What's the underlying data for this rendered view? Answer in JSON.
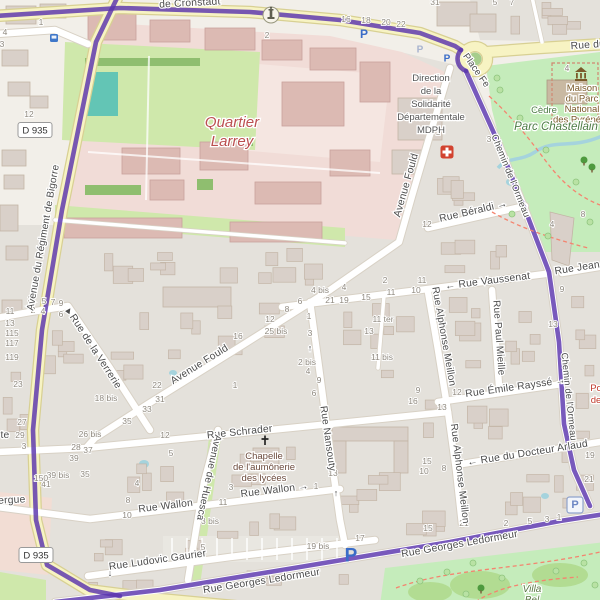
{
  "map": {
    "colors": {
      "base": "#f2efe9",
      "residential": "#e4e1db",
      "building": "#d9d0c9",
      "building_stroke": "#c3b5a6",
      "barracks": "#f1dcd7",
      "barracks_court": "#f5e6e1",
      "barracks_building": "#dcbab3",
      "barracks_building_stroke": "#c9a29b",
      "grass": "#cfe8ab",
      "park": "#c5ecbb",
      "park_blob": "#b2dc92",
      "hedge": "#8fbe6f",
      "pitch": "#63c5b5",
      "road_yellow": "#f7f3c3",
      "road_yellow_casing": "#d8d093",
      "road_white": "#ffffff",
      "road_casing": "#d8d1c5",
      "route_purple": "#5a35ad",
      "water": "#a5d3dd",
      "path_red": "#f4846f",
      "street_text": "#4c4c4c",
      "housenumber_text": "#8f897f",
      "quartier_red": "#bb4f4f",
      "park_text": "#4e7d46",
      "tourism_brown": "#7a5a2a",
      "chapel_text": "#6b4a3c",
      "gray_text": "#555555",
      "poi_red_text": "#c0392b",
      "parking_blue": "#3a6cc8",
      "parking_muted": "#a8b4cf",
      "roundabout_green": "#a6cd8c",
      "medical_red": "#d2422f"
    },
    "street_labels": [
      {
        "text": "de Cronstadt",
        "x": 190,
        "y": 6,
        "rot": -3
      },
      {
        "text": "Place Fe",
        "x": 474,
        "y": 72,
        "rot": 55,
        "s": 9.5
      },
      {
        "text": "Rue du",
        "x": 588,
        "y": 48,
        "rot": -4
      },
      {
        "text": "Avenue du Régiment de Bigorre",
        "x": 46,
        "y": 238,
        "rot": -80,
        "s": 10
      },
      {
        "text": "Avenue Fould",
        "x": 409,
        "y": 186,
        "rot": -74
      },
      {
        "text": "Avenue Fould",
        "x": 201,
        "y": 367,
        "rot": -32
      },
      {
        "text": "Rue Béraldi →",
        "x": 474,
        "y": 214,
        "rot": -13
      },
      {
        "text": "← Rue Vaussenat",
        "x": 488,
        "y": 284,
        "rot": -7
      },
      {
        "text": "Rue Jean R",
        "x": 583,
        "y": 270,
        "rot": -9
      },
      {
        "text": "Rue Alphonse Meillon",
        "x": 441,
        "y": 337,
        "rot": 80,
        "s": 10
      },
      {
        "text": "Rue Alphonse Meillon",
        "x": 457,
        "y": 474,
        "rot": 83,
        "s": 10
      },
      {
        "text": "Rue Paul Mieille",
        "x": 496,
        "y": 338,
        "rot": 86,
        "s": 10
      },
      {
        "text": "Rue Émile Rayssé →",
        "x": 516,
        "y": 390,
        "rot": -8
      },
      {
        "text": "Chemin de l'Ormeau",
        "x": 508,
        "y": 177,
        "rot": 68,
        "s": 9.3
      },
      {
        "text": "Chemin de l'Ormeau",
        "x": 566,
        "y": 397,
        "rot": 84,
        "s": 9.3
      },
      {
        "text": "← Rue du Docteur Arlaud",
        "x": 528,
        "y": 456,
        "rot": -9
      },
      {
        "text": "Rue Schrader",
        "x": 240,
        "y": 435,
        "rot": -6
      },
      {
        "text": "Rue Nansouty",
        "x": 325,
        "y": 439,
        "rot": 82,
        "s": 10
      },
      {
        "text": "Avenue de Huesca",
        "x": 206,
        "y": 477,
        "rot": 102,
        "s": 10
      },
      {
        "text": "Rue Wallon",
        "x": 166,
        "y": 509,
        "rot": -7
      },
      {
        "text": "Rue Wallon →",
        "x": 275,
        "y": 493,
        "rot": -7
      },
      {
        "text": "Rue Ludovic Gaurier",
        "x": 158,
        "y": 563,
        "rot": -8
      },
      {
        "text": "Rue Georges Ledormeur",
        "x": 460,
        "y": 547,
        "rot": -10
      },
      {
        "text": "Rue Georges Ledormeur",
        "x": 262,
        "y": 584,
        "rot": -9
      },
      {
        "text": "Rue de la Verrerie",
        "x": 93,
        "y": 353,
        "rot": 57
      },
      {
        "text": "ergue",
        "x": 12,
        "y": 503,
        "rot": -3
      },
      {
        "text": "te",
        "x": 5,
        "y": 438,
        "rot": 0
      }
    ],
    "arrows": [
      {
        "glyph": "↑",
        "x": 310,
        "y": 351,
        "rot": 0
      },
      {
        "glyph": "↑",
        "x": 336,
        "y": 496,
        "rot": 0
      },
      {
        "glyph": "↓",
        "x": 110,
        "y": 576,
        "rot": 0
      },
      {
        "glyph": "►",
        "x": 71,
        "y": 312,
        "rot": -55
      }
    ],
    "area_labels": [
      {
        "lines": [
          "Quartier",
          "Larrey"
        ],
        "x": 232,
        "y": 127,
        "lh": 19,
        "s": 15,
        "c": "#bb4f4f",
        "i": true
      },
      {
        "lines": [
          "Direction",
          "de la",
          "Solidarité",
          "Départementale",
          "MDPH"
        ],
        "x": 431,
        "y": 81,
        "lh": 13,
        "s": 9.5,
        "c": "#555555"
      },
      {
        "lines": [
          "Maison",
          "du Parc",
          "National",
          "des Pyrénées"
        ],
        "x": 582,
        "y": 91,
        "lh": 10.5,
        "s": 9.5,
        "c": "#7a5a2a"
      },
      {
        "lines": [
          "Cèdre"
        ],
        "x": 544,
        "y": 113,
        "lh": 10,
        "s": 9.5,
        "c": "#4e7d46"
      },
      {
        "lines": [
          "Parc Chastellain"
        ],
        "x": 556,
        "y": 130,
        "lh": 12,
        "s": 11.5,
        "c": "#4e7d46",
        "i": true
      },
      {
        "lines": [
          "Chapelle",
          "de l'aumônerie",
          "des lycées"
        ],
        "x": 264,
        "y": 459,
        "lh": 11,
        "s": 9.5,
        "c": "#6b4a3c"
      },
      {
        "lines": [
          "Villa",
          "Bel"
        ],
        "x": 532,
        "y": 592,
        "lh": 11,
        "s": 10,
        "c": "#5c7a46",
        "i": true
      },
      {
        "lines": [
          "Po",
          "de"
        ],
        "x": 596,
        "y": 391,
        "lh": 12,
        "s": 9.5,
        "c": "#c0392b"
      }
    ],
    "badges": [
      {
        "text": "D 935",
        "x": 35,
        "y": 130
      },
      {
        "text": "D 935",
        "x": 36,
        "y": 555
      }
    ],
    "icons": [
      {
        "name": "monument",
        "x": 271,
        "y": 15
      },
      {
        "name": "bus-stop",
        "x": 54,
        "y": 38
      },
      {
        "name": "parking",
        "x": 364,
        "y": 34,
        "s": 12
      },
      {
        "name": "parking-muted",
        "x": 420,
        "y": 50,
        "s": 10
      },
      {
        "name": "parking",
        "x": 447,
        "y": 59,
        "s": 10
      },
      {
        "name": "parking",
        "x": 351,
        "y": 556,
        "s": 19
      },
      {
        "name": "parking-boxed",
        "x": 575,
        "y": 505
      },
      {
        "name": "medical-cross",
        "x": 447,
        "y": 152
      },
      {
        "name": "church-cross",
        "x": 265,
        "y": 441
      },
      {
        "name": "museum",
        "x": 581,
        "y": 75
      },
      {
        "name": "tree",
        "x": 584,
        "y": 160
      },
      {
        "name": "tree",
        "x": 592,
        "y": 167
      },
      {
        "name": "tree",
        "x": 481,
        "y": 588
      }
    ],
    "house_numbers": [
      {
        "t": "1",
        "x": 41,
        "y": 25
      },
      {
        "t": "4",
        "x": 5,
        "y": 35
      },
      {
        "t": "3",
        "x": 2,
        "y": 47
      },
      {
        "t": "12",
        "x": 29,
        "y": 117
      },
      {
        "t": "2",
        "x": 267,
        "y": 38
      },
      {
        "t": "16",
        "x": 346,
        "y": 22
      },
      {
        "t": "18",
        "x": 366,
        "y": 23
      },
      {
        "t": "20",
        "x": 386,
        "y": 25
      },
      {
        "t": "22",
        "x": 401,
        "y": 27
      },
      {
        "t": "31",
        "x": 435,
        "y": 5
      },
      {
        "t": "5",
        "x": 495,
        "y": 5
      },
      {
        "t": "7",
        "x": 512,
        "y": 5
      },
      {
        "t": "4",
        "x": 567,
        "y": 71
      },
      {
        "t": "1",
        "x": 438,
        "y": 135
      },
      {
        "t": "3",
        "x": 489,
        "y": 142
      },
      {
        "t": "12",
        "x": 427,
        "y": 227
      },
      {
        "t": "4",
        "x": 552,
        "y": 227
      },
      {
        "t": "8",
        "x": 583,
        "y": 217
      },
      {
        "t": "2",
        "x": 528,
        "y": 278
      },
      {
        "t": "11",
        "x": 422,
        "y": 283
      },
      {
        "t": "3",
        "x": 30,
        "y": 302
      },
      {
        "t": "5",
        "x": 44,
        "y": 304
      },
      {
        "t": "7",
        "x": 53,
        "y": 305
      },
      {
        "t": "9",
        "x": 61,
        "y": 306
      },
      {
        "t": "2",
        "x": 33,
        "y": 313
      },
      {
        "t": "4",
        "x": 43,
        "y": 314
      },
      {
        "t": "6",
        "x": 61,
        "y": 317
      },
      {
        "t": "11",
        "x": 10,
        "y": 314
      },
      {
        "t": "13",
        "x": 10,
        "y": 326
      },
      {
        "t": "115",
        "x": 12,
        "y": 336
      },
      {
        "t": "117",
        "x": 12,
        "y": 346
      },
      {
        "t": "119",
        "x": 12,
        "y": 360
      },
      {
        "t": "23",
        "x": 18,
        "y": 387
      },
      {
        "t": "27",
        "x": 22,
        "y": 425
      },
      {
        "t": "29",
        "x": 20,
        "y": 438
      },
      {
        "t": "3",
        "x": 24,
        "y": 449
      },
      {
        "t": "12",
        "x": 270,
        "y": 322
      },
      {
        "t": "25 bis",
        "x": 276,
        "y": 334
      },
      {
        "t": "16",
        "x": 238,
        "y": 339
      },
      {
        "t": "8",
        "x": 287,
        "y": 312
      },
      {
        "t": "6",
        "x": 300,
        "y": 304
      },
      {
        "t": "1",
        "x": 309,
        "y": 319
      },
      {
        "t": "3",
        "x": 310,
        "y": 336
      },
      {
        "t": "22",
        "x": 157,
        "y": 388
      },
      {
        "t": "31",
        "x": 160,
        "y": 402
      },
      {
        "t": "33",
        "x": 147,
        "y": 412
      },
      {
        "t": "35",
        "x": 127,
        "y": 424
      },
      {
        "t": "18 bis",
        "x": 106,
        "y": 401
      },
      {
        "t": "1",
        "x": 235,
        "y": 388
      },
      {
        "t": "26 bis",
        "x": 90,
        "y": 437
      },
      {
        "t": "28",
        "x": 76,
        "y": 450
      },
      {
        "t": "37",
        "x": 88,
        "y": 453
      },
      {
        "t": "39",
        "x": 74,
        "y": 461
      },
      {
        "t": "39 bis",
        "x": 58,
        "y": 478
      },
      {
        "t": "41",
        "x": 46,
        "y": 487
      },
      {
        "t": "35",
        "x": 85,
        "y": 477
      },
      {
        "t": "150",
        "x": 41,
        "y": 481
      },
      {
        "t": "4 bis",
        "x": 320,
        "y": 293
      },
      {
        "t": "4",
        "x": 344,
        "y": 290
      },
      {
        "t": "2",
        "x": 385,
        "y": 283
      },
      {
        "t": "21",
        "x": 330,
        "y": 303
      },
      {
        "t": "19",
        "x": 344,
        "y": 303
      },
      {
        "t": "15",
        "x": 366,
        "y": 300
      },
      {
        "t": "11",
        "x": 391,
        "y": 295
      },
      {
        "t": "10",
        "x": 416,
        "y": 293
      },
      {
        "t": "11 ter",
        "x": 383,
        "y": 322
      },
      {
        "t": "13",
        "x": 369,
        "y": 334
      },
      {
        "t": "11 bis",
        "x": 382,
        "y": 360
      },
      {
        "t": "2 bis",
        "x": 307,
        "y": 365
      },
      {
        "t": "4",
        "x": 308,
        "y": 374
      },
      {
        "t": "9",
        "x": 319,
        "y": 383
      },
      {
        "t": "6",
        "x": 314,
        "y": 396
      },
      {
        "t": "16",
        "x": 413,
        "y": 404
      },
      {
        "t": "13",
        "x": 442,
        "y": 410
      },
      {
        "t": "9",
        "x": 418,
        "y": 393
      },
      {
        "t": "13",
        "x": 553,
        "y": 327
      },
      {
        "t": "9",
        "x": 562,
        "y": 292
      },
      {
        "t": "12",
        "x": 457,
        "y": 395
      },
      {
        "t": "12",
        "x": 165,
        "y": 438
      },
      {
        "t": "5",
        "x": 171,
        "y": 456
      },
      {
        "t": "4",
        "x": 137,
        "y": 486
      },
      {
        "t": "8",
        "x": 128,
        "y": 503
      },
      {
        "t": "10",
        "x": 127,
        "y": 518
      },
      {
        "t": "3",
        "x": 231,
        "y": 490
      },
      {
        "t": "11",
        "x": 223,
        "y": 505
      },
      {
        "t": "3 bis",
        "x": 210,
        "y": 524
      },
      {
        "t": "5",
        "x": 203,
        "y": 550
      },
      {
        "t": "19 bis",
        "x": 318,
        "y": 549
      },
      {
        "t": "17",
        "x": 360,
        "y": 541
      },
      {
        "t": "13",
        "x": 333,
        "y": 476
      },
      {
        "t": "1",
        "x": 316,
        "y": 489
      },
      {
        "t": "15",
        "x": 427,
        "y": 464
      },
      {
        "t": "10",
        "x": 424,
        "y": 474
      },
      {
        "t": "8",
        "x": 444,
        "y": 471
      },
      {
        "t": "21",
        "x": 464,
        "y": 526
      },
      {
        "t": "15",
        "x": 428,
        "y": 531
      },
      {
        "t": "2",
        "x": 506,
        "y": 526
      },
      {
        "t": "5",
        "x": 530,
        "y": 524
      },
      {
        "t": "3",
        "x": 547,
        "y": 522
      },
      {
        "t": "1",
        "x": 559,
        "y": 520
      },
      {
        "t": "19",
        "x": 590,
        "y": 458
      },
      {
        "t": "21",
        "x": 589,
        "y": 482
      }
    ]
  }
}
